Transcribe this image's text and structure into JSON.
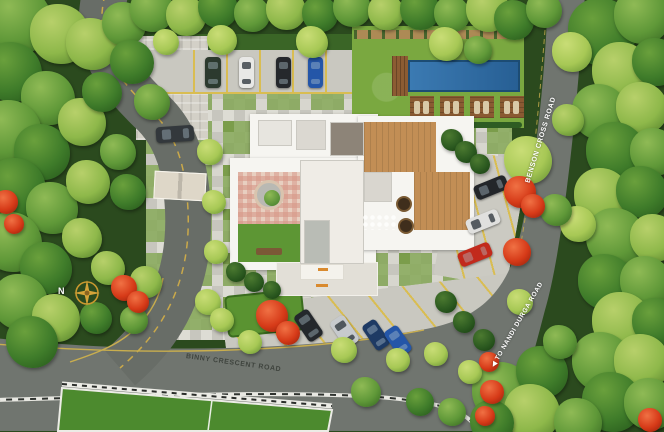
{
  "labels": {
    "binny_crescent_road": "BINNY CRESCENT ROAD",
    "benson_cross_road": "BENSON CROSS ROAD",
    "to_nandi_durga_road": "◀ TO NANDI DURGA ROAD",
    "north": "N"
  },
  "colors": {
    "road": "#70756f",
    "marking_yellow": "#c9ae4e",
    "paver_light": "#dddcd4",
    "paver_dark": "#bfbfb7",
    "paver_green": "#7a9c4a",
    "lawn": "#7aa840",
    "court_green": "#4c8a2e",
    "pool_water": "#2e6ba4",
    "deck_wood": "#8a5a32",
    "building_white": "#f6f5f1",
    "flower_red": "#d63a18",
    "compass_gold": "#d4a339",
    "wall_white": "#ecece6",
    "tree_palette": [
      "#8eb84a",
      "#5f9838",
      "#3f7c2a",
      "#2c5a20",
      "#a7c855"
    ]
  },
  "vehicles": [
    {
      "x": 205,
      "y": 57,
      "w": 16,
      "h": 31,
      "rot": 0,
      "color": "#2c3a2e"
    },
    {
      "x": 239,
      "y": 57,
      "w": 15,
      "h": 31,
      "rot": 0,
      "color": "#e8e8e6"
    },
    {
      "x": 276,
      "y": 57,
      "w": 15,
      "h": 31,
      "rot": 0,
      "color": "#25282c"
    },
    {
      "x": 308,
      "y": 57,
      "w": 15,
      "h": 31,
      "rot": 0,
      "color": "#2456a8"
    },
    {
      "x": 156,
      "y": 126,
      "w": 38,
      "h": 16,
      "rot": -4,
      "color": "#33383c"
    },
    {
      "x": 474,
      "y": 180,
      "w": 34,
      "h": 15,
      "rot": -22,
      "color": "#23262a"
    },
    {
      "x": 466,
      "y": 214,
      "w": 34,
      "h": 15,
      "rot": -22,
      "color": "#e0e0de"
    },
    {
      "x": 458,
      "y": 247,
      "w": 34,
      "h": 15,
      "rot": -22,
      "color": "#c22a1c"
    },
    {
      "x": 300,
      "y": 310,
      "w": 17,
      "h": 31,
      "rot": -34,
      "color": "#24282c"
    },
    {
      "x": 336,
      "y": 316,
      "w": 17,
      "h": 31,
      "rot": -34,
      "color": "#c7cacd"
    },
    {
      "x": 368,
      "y": 320,
      "w": 16,
      "h": 30,
      "rot": -34,
      "color": "#1e3a64"
    },
    {
      "x": 390,
      "y": 326,
      "w": 16,
      "h": 30,
      "rot": -34,
      "color": "#2456a8"
    }
  ],
  "trees": [
    [
      18,
      20,
      34,
      1
    ],
    [
      60,
      34,
      30,
      0
    ],
    [
      12,
      72,
      30,
      2
    ],
    [
      48,
      98,
      27,
      1
    ],
    [
      92,
      44,
      26,
      0
    ],
    [
      124,
      24,
      22,
      1
    ],
    [
      10,
      132,
      32,
      1
    ],
    [
      42,
      152,
      28,
      2
    ],
    [
      82,
      122,
      24,
      0
    ],
    [
      16,
      188,
      30,
      2
    ],
    [
      52,
      208,
      26,
      1
    ],
    [
      88,
      182,
      22,
      0
    ],
    [
      12,
      242,
      30,
      1
    ],
    [
      46,
      268,
      26,
      2
    ],
    [
      82,
      238,
      20,
      0
    ],
    [
      20,
      302,
      28,
      1
    ],
    [
      56,
      318,
      24,
      0
    ],
    [
      32,
      342,
      26,
      2
    ],
    [
      102,
      92,
      20,
      2
    ],
    [
      118,
      152,
      18,
      1
    ],
    [
      108,
      268,
      17,
      0
    ],
    [
      96,
      318,
      16,
      2
    ],
    [
      134,
      320,
      14,
      1
    ],
    [
      152,
      10,
      22,
      1
    ],
    [
      186,
      16,
      20,
      0
    ],
    [
      218,
      8,
      20,
      2
    ],
    [
      252,
      14,
      18,
      1
    ],
    [
      286,
      10,
      20,
      0
    ],
    [
      320,
      14,
      18,
      2
    ],
    [
      352,
      8,
      19,
      1
    ],
    [
      386,
      12,
      18,
      0
    ],
    [
      420,
      10,
      20,
      2
    ],
    [
      452,
      14,
      18,
      1
    ],
    [
      488,
      10,
      22,
      0
    ],
    [
      514,
      20,
      20,
      2
    ],
    [
      544,
      10,
      18,
      1
    ],
    [
      222,
      40,
      15,
      4
    ],
    [
      312,
      42,
      16,
      4
    ],
    [
      446,
      44,
      17,
      4
    ],
    [
      478,
      50,
      14,
      1
    ],
    [
      166,
      42,
      13,
      4
    ],
    [
      602,
      32,
      34,
      2
    ],
    [
      642,
      16,
      28,
      1
    ],
    [
      622,
      72,
      30,
      0
    ],
    [
      656,
      62,
      24,
      2
    ],
    [
      600,
      112,
      28,
      1
    ],
    [
      642,
      108,
      26,
      0
    ],
    [
      616,
      152,
      30,
      2
    ],
    [
      654,
      152,
      24,
      1
    ],
    [
      602,
      196,
      28,
      0
    ],
    [
      642,
      192,
      26,
      2
    ],
    [
      616,
      238,
      30,
      1
    ],
    [
      654,
      238,
      24,
      0
    ],
    [
      606,
      282,
      28,
      2
    ],
    [
      646,
      282,
      26,
      1
    ],
    [
      622,
      322,
      30,
      0
    ],
    [
      656,
      322,
      24,
      2
    ],
    [
      602,
      362,
      30,
      1
    ],
    [
      642,
      362,
      28,
      0
    ],
    [
      612,
      402,
      30,
      2
    ],
    [
      650,
      404,
      26,
      1
    ],
    [
      572,
      52,
      20,
      4
    ],
    [
      578,
      224,
      18,
      4
    ],
    [
      568,
      120,
      16,
      0
    ],
    [
      528,
      160,
      24,
      4
    ],
    [
      556,
      210,
      16,
      1
    ],
    [
      502,
      392,
      30,
      1
    ],
    [
      542,
      372,
      26,
      2
    ],
    [
      532,
      412,
      28,
      0
    ],
    [
      578,
      422,
      24,
      1
    ],
    [
      492,
      422,
      22,
      2
    ],
    [
      560,
      342,
      17,
      1
    ],
    [
      520,
      302,
      13,
      4
    ],
    [
      366,
      392,
      15,
      1
    ],
    [
      420,
      402,
      14,
      2
    ],
    [
      452,
      412,
      14,
      1
    ],
    [
      132,
      62,
      22,
      2
    ],
    [
      152,
      102,
      18,
      1
    ],
    [
      128,
      192,
      18,
      2
    ],
    [
      146,
      282,
      16,
      0
    ],
    [
      210,
      152,
      13,
      4
    ],
    [
      214,
      202,
      12,
      4
    ],
    [
      216,
      252,
      12,
      4
    ],
    [
      208,
      302,
      13,
      4
    ],
    [
      222,
      320,
      12,
      4
    ],
    [
      250,
      342,
      12,
      4
    ],
    [
      344,
      350,
      13,
      4
    ],
    [
      398,
      360,
      12,
      4
    ],
    [
      436,
      354,
      12,
      4
    ],
    [
      470,
      372,
      12,
      4
    ],
    [
      452,
      140,
      11,
      3
    ],
    [
      466,
      152,
      11,
      3
    ],
    [
      480,
      164,
      10,
      3
    ],
    [
      446,
      302,
      11,
      3
    ],
    [
      464,
      322,
      11,
      3
    ],
    [
      484,
      340,
      11,
      3
    ],
    [
      236,
      272,
      10,
      3
    ],
    [
      254,
      282,
      10,
      3
    ],
    [
      272,
      290,
      9,
      3
    ]
  ],
  "flowers": [
    [
      6,
      202,
      12
    ],
    [
      14,
      224,
      10
    ],
    [
      124,
      288,
      13
    ],
    [
      138,
      302,
      11
    ],
    [
      272,
      316,
      16
    ],
    [
      288,
      333,
      12
    ],
    [
      520,
      192,
      16
    ],
    [
      533,
      206,
      12
    ],
    [
      517,
      252,
      14
    ],
    [
      489,
      362,
      10
    ],
    [
      492,
      392,
      12
    ],
    [
      485,
      416,
      10
    ],
    [
      650,
      420,
      12
    ]
  ]
}
